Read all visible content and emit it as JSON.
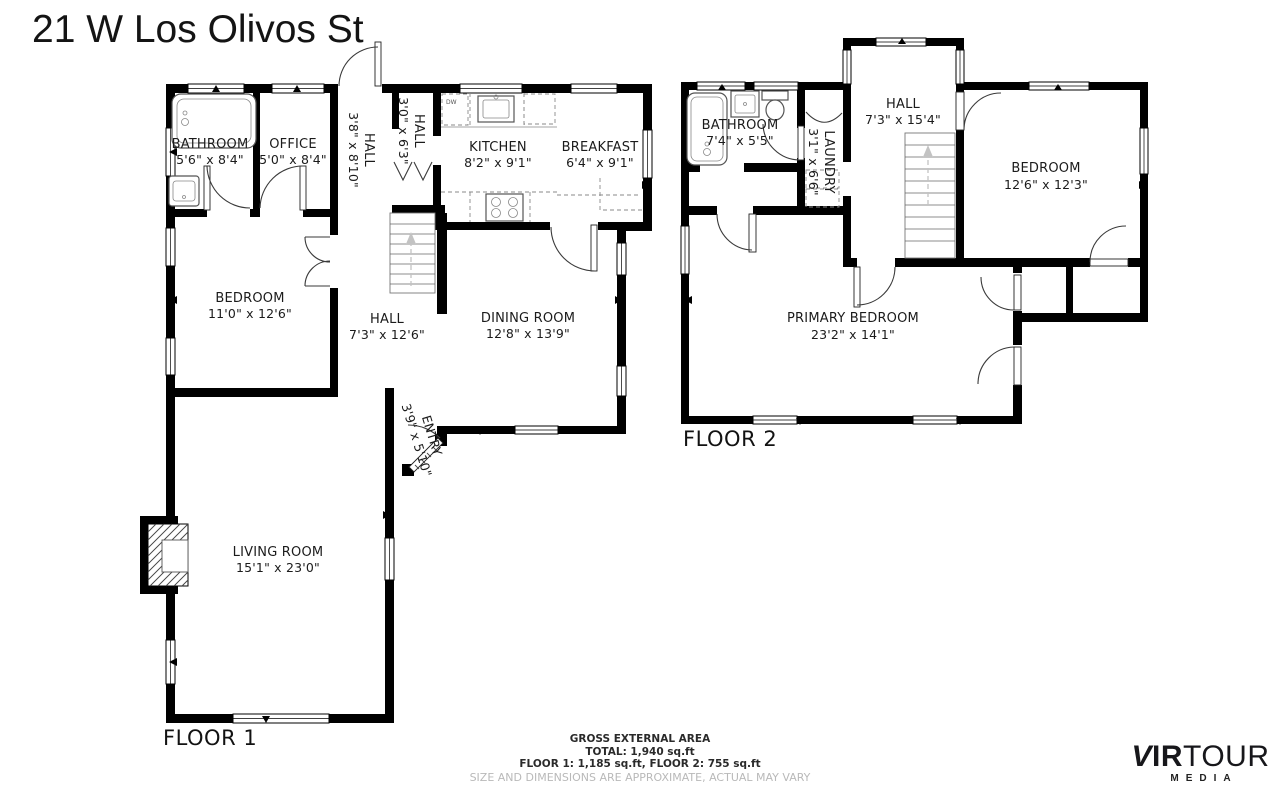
{
  "title": "21 W Los Olivos St",
  "floor1": {
    "label": "FLOOR 1",
    "rooms": [
      {
        "name": "BATHROOM",
        "dims": "5'6\" x 8'4\""
      },
      {
        "name": "OFFICE",
        "dims": "5'0\" x 8'4\""
      },
      {
        "name": "HALL",
        "dims": "3'8\" x 8'10\""
      },
      {
        "name": "HALL",
        "dims": "3'0\" x 6'3\""
      },
      {
        "name": "KITCHEN",
        "dims": "8'2\" x 9'1\""
      },
      {
        "name": "BREAKFAST",
        "dims": "6'4\" x 9'1\""
      },
      {
        "name": "BEDROOM",
        "dims": "11'0\" x 12'6\""
      },
      {
        "name": "HALL",
        "dims": "7'3\" x 12'6\""
      },
      {
        "name": "DINING ROOM",
        "dims": "12'8\" x 13'9\""
      },
      {
        "name": "ENTRY",
        "dims": "3'9\" x 5'10\""
      },
      {
        "name": "LIVING ROOM",
        "dims": "15'1\" x 23'0\""
      }
    ],
    "appliance_labels": {
      "dishwasher": "DW"
    }
  },
  "floor2": {
    "label": "FLOOR 2",
    "rooms": [
      {
        "name": "BATHROOM",
        "dims": "7'4\" x 5'5\""
      },
      {
        "name": "LAUNDRY",
        "dims": "3'1\" x 6'6\""
      },
      {
        "name": "HALL",
        "dims": "7'3\" x 15'4\""
      },
      {
        "name": "BEDROOM",
        "dims": "12'6\" x 12'3\""
      },
      {
        "name": "PRIMARY BEDROOM",
        "dims": "23'2\" x 14'1\""
      }
    ]
  },
  "footer": {
    "line1": "GROSS EXTERNAL AREA",
    "line2": "TOTAL: 1,940 sq.ft",
    "line3": "FLOOR 1: 1,185 sq.ft, FLOOR 2: 755 sq.ft",
    "disclaimer": "SIZE AND DIMENSIONS ARE APPROXIMATE, ACTUAL MAY VARY"
  },
  "logo": {
    "v": "V",
    "ir": "IR",
    "tour": "TOUR",
    "media": "MEDIA"
  },
  "colors": {
    "wall": "#000000",
    "background": "#ffffff",
    "muted_text": "#b9b9b9"
  }
}
